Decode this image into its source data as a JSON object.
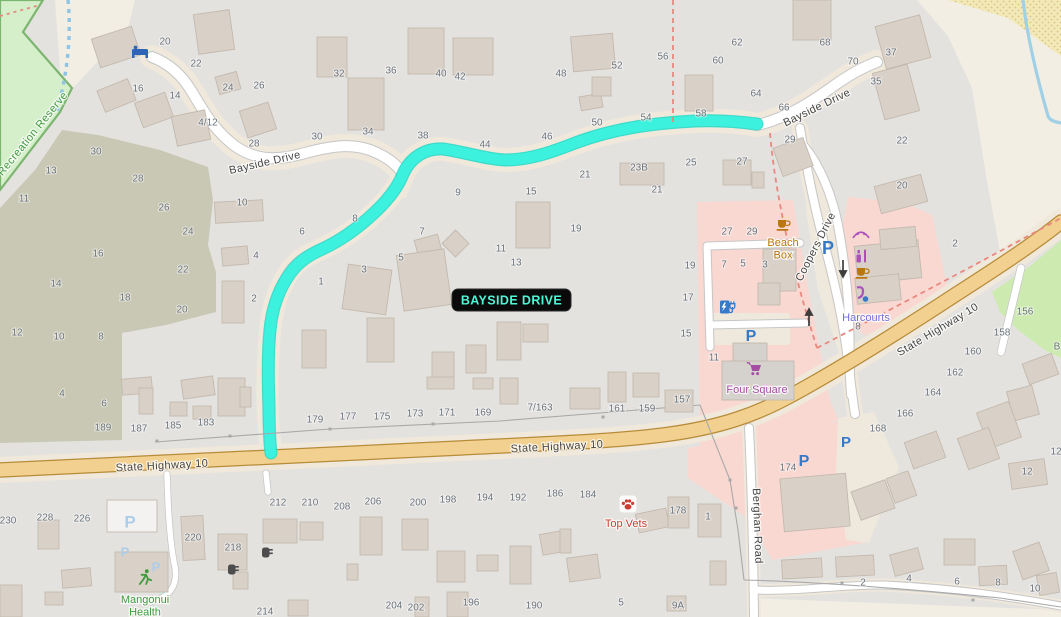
{
  "route_label": {
    "text": "BAYSIDE DRIVE"
  },
  "colors": {
    "base": "#e4e2df",
    "beige": "#f2eee3",
    "margin": "#efe8db",
    "reserve": "#d5efcb",
    "reserve_border": "#7cb56f",
    "scrub": "#c9c8b4",
    "sand": "#f3e9b8",
    "sand_dot": "#d9c583",
    "water": "#9fd0e5",
    "retail": "#f9d8d2",
    "grass": "#cdebb0",
    "building": "#d9d0c7",
    "building_border": "#c3b9ae",
    "building_gray": "#d5d2cd",
    "building_white": "#f3f2f0",
    "road_white": "#ffffff",
    "road_casing": "#c6c6c6",
    "highway_fill": "#f2d190",
    "highway_casing": "#b78b38",
    "route": "#3cf2de",
    "route_edge": "#22dcc8",
    "parking_blue": "#3579c8",
    "parking_private": "#abcdea",
    "number_gray": "#6a737b",
    "label_dark": "#454545",
    "boundary_red": "#e8887e",
    "path_blue": "#8ec4e4",
    "fence": "#a9a9a9",
    "label_green": "#3f9a3c",
    "label_orange": "#b9770e",
    "label_purple": "#a44fa4",
    "label_red": "#cc3d33",
    "label_office": "#7070d8",
    "beauty_purple": "#ab4fbc",
    "route_label_bg": "#0a0a0a",
    "route_label_text": "#4bf7d6",
    "arrow_dark": "#3d3d3d",
    "bin_gray": "#4d4d4d",
    "bed_blue": "#2e63b8"
  },
  "road_labels": [
    {
      "text": "Bayside Drive",
      "x": 265,
      "y": 163,
      "angle": -13,
      "color_key": "label_dark"
    },
    {
      "text": "Bayside Drive",
      "x": 817,
      "y": 108,
      "angle": -26,
      "color_key": "label_dark"
    },
    {
      "text": "Coopers Drive",
      "x": 816,
      "y": 247,
      "angle": -63,
      "color_key": "label_dark"
    },
    {
      "text": "State Highway 10",
      "x": 162,
      "y": 466,
      "angle": -3,
      "color_key": "label_dark"
    },
    {
      "text": "State Highway 10",
      "x": 557,
      "y": 447,
      "angle": -3,
      "color_key": "label_dark"
    },
    {
      "text": "State Highway 10",
      "x": 938,
      "y": 330,
      "angle": -31,
      "color_key": "label_dark"
    },
    {
      "text": "Berghan Road",
      "x": 757,
      "y": 526,
      "angle": 88,
      "color_key": "label_dark"
    },
    {
      "text": "Recreation Reserve",
      "x": 33,
      "y": 134,
      "angle": -51,
      "color_key": "label_green"
    }
  ],
  "poi_labels": [
    {
      "name": "beach-box-label",
      "lines": [
        "Beach",
        "Box"
      ],
      "x": 783,
      "y": 243,
      "color_key": "label_orange"
    },
    {
      "name": "four-square-label",
      "lines": [
        "Four Square"
      ],
      "x": 757,
      "y": 390,
      "color_key": "label_purple"
    },
    {
      "name": "harcourts-label",
      "lines": [
        "Harcourts"
      ],
      "x": 866,
      "y": 318,
      "color_key": "label_office"
    },
    {
      "name": "top-vets-label",
      "lines": [
        "Top Vets"
      ],
      "x": 626,
      "y": 524,
      "color_key": "label_red"
    },
    {
      "name": "mangonui-health-label",
      "lines": [
        "Mangonui",
        "Health"
      ],
      "x": 145,
      "y": 600,
      "color_key": "label_green"
    }
  ],
  "housenumbers": [
    [
      "20",
      165,
      42
    ],
    [
      "22",
      196,
      64
    ],
    [
      "16",
      138,
      89
    ],
    [
      "14",
      175,
      96
    ],
    [
      "24",
      228,
      88
    ],
    [
      "26",
      259,
      86
    ],
    [
      "4/12",
      208,
      123
    ],
    [
      "28",
      254,
      144
    ],
    [
      "30",
      96,
      152
    ],
    [
      "13",
      51,
      171
    ],
    [
      "28",
      138,
      179
    ],
    [
      "11",
      24,
      199
    ],
    [
      "32",
      339,
      74
    ],
    [
      "36",
      391,
      71
    ],
    [
      "40",
      441,
      74
    ],
    [
      "42",
      460,
      77
    ],
    [
      "30",
      317,
      137
    ],
    [
      "34",
      368,
      132
    ],
    [
      "38",
      423,
      136
    ],
    [
      "44",
      485,
      145
    ],
    [
      "46",
      547,
      137
    ],
    [
      "48",
      561,
      74
    ],
    [
      "52",
      617,
      66
    ],
    [
      "56",
      663,
      57
    ],
    [
      "60",
      718,
      61
    ],
    [
      "62",
      737,
      43
    ],
    [
      "68",
      825,
      43
    ],
    [
      "50",
      597,
      123
    ],
    [
      "54",
      646,
      118
    ],
    [
      "58",
      701,
      114
    ],
    [
      "64",
      756,
      94
    ],
    [
      "66",
      784,
      108
    ],
    [
      "70",
      853,
      62
    ],
    [
      "37",
      891,
      53
    ],
    [
      "35",
      876,
      82
    ],
    [
      "22",
      902,
      141
    ],
    [
      "29",
      790,
      140
    ],
    [
      "21",
      585,
      175
    ],
    [
      "23B",
      639,
      168
    ],
    [
      "25",
      691,
      163
    ],
    [
      "27",
      742,
      162
    ],
    [
      "21",
      657,
      190
    ],
    [
      "19",
      576,
      229
    ],
    [
      "9",
      458,
      193
    ],
    [
      "15",
      531,
      192
    ],
    [
      "10",
      242,
      203
    ],
    [
      "4",
      256,
      256
    ],
    [
      "2",
      254,
      299
    ],
    [
      "26",
      164,
      208
    ],
    [
      "24",
      188,
      232
    ],
    [
      "16",
      98,
      254
    ],
    [
      "22",
      183,
      270
    ],
    [
      "14",
      56,
      284
    ],
    [
      "18",
      125,
      298
    ],
    [
      "20",
      182,
      310
    ],
    [
      "12",
      17,
      333
    ],
    [
      "10",
      59,
      337
    ],
    [
      "8",
      101,
      337
    ],
    [
      "6",
      302,
      232
    ],
    [
      "8",
      355,
      219
    ],
    [
      "1",
      321,
      282
    ],
    [
      "3",
      364,
      270
    ],
    [
      "5",
      401,
      258
    ],
    [
      "7",
      422,
      232
    ],
    [
      "11",
      501,
      249
    ],
    [
      "13",
      516,
      263
    ],
    [
      "4",
      62,
      394
    ],
    [
      "6",
      104,
      404
    ],
    [
      "189",
      103,
      428
    ],
    [
      "187",
      139,
      429
    ],
    [
      "185",
      173,
      426
    ],
    [
      "183",
      206,
      423
    ],
    [
      "179",
      315,
      420
    ],
    [
      "177",
      348,
      417
    ],
    [
      "175",
      382,
      417
    ],
    [
      "173",
      415,
      414
    ],
    [
      "171",
      447,
      413
    ],
    [
      "169",
      483,
      413
    ],
    [
      "7/163",
      540,
      408
    ],
    [
      "161",
      617,
      409
    ],
    [
      "159",
      647,
      409
    ],
    [
      "157",
      682,
      400
    ],
    [
      "27",
      727,
      232
    ],
    [
      "29",
      752,
      232
    ],
    [
      "7",
      724,
      265
    ],
    [
      "5",
      743,
      264
    ],
    [
      "3",
      765,
      265
    ],
    [
      "19",
      690,
      266
    ],
    [
      "17",
      688,
      298
    ],
    [
      "15",
      686,
      334
    ],
    [
      "11",
      714,
      358
    ],
    [
      "20",
      902,
      186
    ],
    [
      "2",
      955,
      244
    ],
    [
      "8",
      858,
      327
    ],
    [
      "156",
      1025,
      312
    ],
    [
      "158",
      1002,
      333
    ],
    [
      "160",
      973,
      352
    ],
    [
      "162",
      955,
      373
    ],
    [
      "164",
      933,
      393
    ],
    [
      "166",
      905,
      414
    ],
    [
      "168",
      878,
      429
    ],
    [
      "12",
      1027,
      472
    ],
    [
      "12",
      1056,
      452
    ],
    [
      "174",
      788,
      468
    ],
    [
      "B",
      1057,
      347
    ],
    [
      "230",
      8,
      521
    ],
    [
      "228",
      45,
      518
    ],
    [
      "226",
      82,
      519
    ],
    [
      "220",
      193,
      538
    ],
    [
      "218",
      233,
      548
    ],
    [
      "212",
      278,
      503
    ],
    [
      "210",
      310,
      503
    ],
    [
      "208",
      342,
      507
    ],
    [
      "206",
      373,
      502
    ],
    [
      "200",
      418,
      503
    ],
    [
      "198",
      448,
      500
    ],
    [
      "194",
      485,
      498
    ],
    [
      "192",
      518,
      498
    ],
    [
      "186",
      555,
      494
    ],
    [
      "184",
      588,
      495
    ],
    [
      "178",
      678,
      511
    ],
    [
      "1",
      708,
      517
    ],
    [
      "214",
      265,
      612
    ],
    [
      "204",
      394,
      606
    ],
    [
      "202",
      416,
      608
    ],
    [
      "196",
      471,
      603
    ],
    [
      "190",
      534,
      606
    ],
    [
      "5",
      621,
      603
    ],
    [
      "9A",
      678,
      606
    ],
    [
      "2",
      863,
      583
    ],
    [
      "4",
      909,
      579
    ],
    [
      "6",
      957,
      582
    ],
    [
      "8",
      998,
      583
    ],
    [
      "10",
      1035,
      589
    ]
  ],
  "icons": [
    {
      "name": "bed-icon",
      "x": 140,
      "y": 52
    },
    {
      "name": "cafe-icon",
      "x": 783,
      "y": 224
    },
    {
      "name": "cafe-icon",
      "x": 862,
      "y": 272
    },
    {
      "name": "beauty-icon",
      "x": 861,
      "y": 234
    },
    {
      "name": "cosmetics-icon",
      "x": 862,
      "y": 256
    },
    {
      "name": "massage-icon",
      "x": 861,
      "y": 294
    },
    {
      "name": "shopping-cart-icon",
      "x": 756,
      "y": 369
    },
    {
      "name": "paw-icon",
      "x": 628,
      "y": 504
    },
    {
      "name": "runner-icon",
      "x": 145,
      "y": 577
    },
    {
      "name": "waste-bin-icon",
      "x": 232,
      "y": 569
    },
    {
      "name": "waste-bin-icon",
      "x": 266,
      "y": 552
    },
    {
      "name": "ev-charging-icon",
      "x": 727,
      "y": 307
    },
    {
      "name": "arrow-down-icon",
      "x": 843,
      "y": 268
    },
    {
      "name": "arrow-up-icon",
      "x": 809,
      "y": 318
    },
    {
      "name": "parking-icon",
      "x": 828,
      "y": 249,
      "glyph": "P",
      "size": 18
    },
    {
      "name": "parking-icon",
      "x": 751,
      "y": 337,
      "glyph": "P",
      "size": 16
    },
    {
      "name": "parking-icon",
      "x": 846,
      "y": 443,
      "glyph": "P",
      "size": 15
    },
    {
      "name": "parking-icon",
      "x": 804,
      "y": 462,
      "glyph": "P",
      "size": 16
    },
    {
      "name": "parking-private-icon",
      "x": 130,
      "y": 523,
      "glyph": "P",
      "size": 17
    },
    {
      "name": "parking-private-icon",
      "x": 125,
      "y": 553,
      "glyph": "P",
      "size": 13
    },
    {
      "name": "parking-private-icon",
      "x": 156,
      "y": 568,
      "glyph": "P",
      "size": 13
    }
  ]
}
